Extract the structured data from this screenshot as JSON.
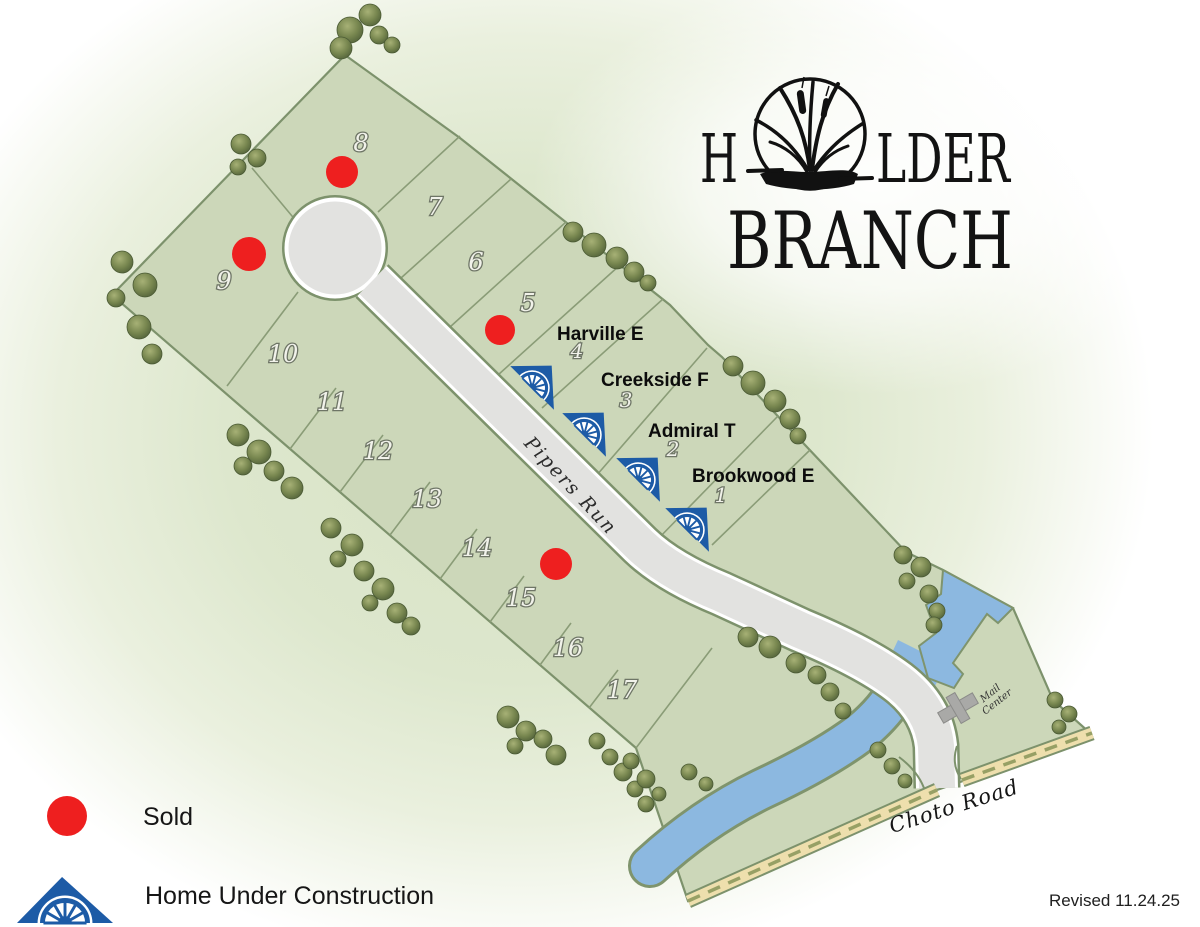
{
  "logo": {
    "line1_prefix": "H",
    "line1_suffix": "LDER",
    "line2": "BRANCH"
  },
  "map": {
    "street_label": "Pipers Run",
    "main_road_label": "Choto Road",
    "mail_center": {
      "line1": "Mail",
      "line2": "Center"
    },
    "lots": [
      {
        "n": "1"
      },
      {
        "n": "2"
      },
      {
        "n": "3"
      },
      {
        "n": "4"
      },
      {
        "n": "5"
      },
      {
        "n": "6"
      },
      {
        "n": "7"
      },
      {
        "n": "8"
      },
      {
        "n": "9"
      },
      {
        "n": "10"
      },
      {
        "n": "11"
      },
      {
        "n": "12"
      },
      {
        "n": "13"
      },
      {
        "n": "14"
      },
      {
        "n": "15"
      },
      {
        "n": "16"
      },
      {
        "n": "17"
      }
    ],
    "model_labels": [
      {
        "name": "Harville E"
      },
      {
        "name": "Creekside F"
      },
      {
        "name": "Admiral T"
      },
      {
        "name": "Brookwood E"
      }
    ],
    "sold_lots": [
      "5",
      "8",
      "9",
      "15"
    ],
    "under_construction_lots": [
      "1",
      "2",
      "3",
      "4"
    ]
  },
  "legend": {
    "sold_label": "Sold",
    "construction_label": "Home Under Construction"
  },
  "footer": {
    "revised_label": "Revised 11.24.25"
  },
  "colors": {
    "sold_red": "#ee1f1f",
    "construction_blue": "#1d5ba6",
    "parcel_green": "#ccd7b9",
    "water_blue": "#8cb8e0",
    "road_gray": "#e2e2e0",
    "choto_tan": "#eedfad",
    "line_green": "#7d926c"
  }
}
